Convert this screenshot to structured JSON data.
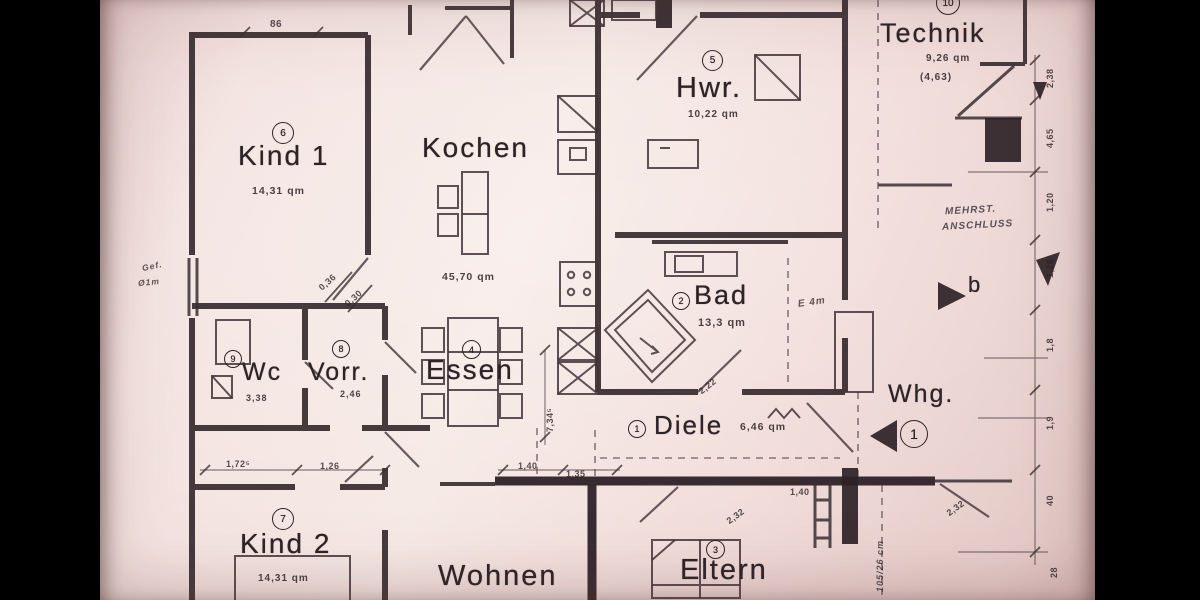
{
  "rooms": {
    "kind1": {
      "label": "Kind 1",
      "number": "6",
      "area": "14,31 qm"
    },
    "kochen": {
      "label": "Kochen",
      "area": "45,70 qm"
    },
    "hwr": {
      "label": "Hwr.",
      "number": "5",
      "area": "10,22 qm"
    },
    "technik": {
      "label": "Technik",
      "number": "10",
      "area": "9,26 qm",
      "area_alt": "(4,63)"
    },
    "bad": {
      "label": "Bad",
      "number": "2",
      "area": "13,3 qm"
    },
    "wc": {
      "label": "Wc",
      "number": "9",
      "area": "3,38"
    },
    "vorr": {
      "label": "Vorr.",
      "number": "8",
      "area": "2,46"
    },
    "essen": {
      "label": "Essen",
      "number": "4"
    },
    "diele": {
      "label": "Diele",
      "number": "1",
      "area": "6,46 qm"
    },
    "kind2": {
      "label": "Kind 2",
      "number": "7",
      "area": "14,31 qm"
    },
    "wohnen": {
      "label": "Wohnen"
    },
    "eltern": {
      "label": "Eltern",
      "number": "3"
    }
  },
  "unit": {
    "label": "Whg.",
    "number": "1"
  },
  "markers": {
    "b": "b"
  },
  "notes": {
    "line1": "MEHRST.",
    "line2": "ANSCHLUSS",
    "shaft": "105/26 cm",
    "e": "E 4m",
    "gef": "Gef.",
    "diam": "Ø1m"
  },
  "dims": {
    "top": "86",
    "diag1": "0,36",
    "diag2": "0,30",
    "kind2_a": "1,72⁵",
    "kind2_b": "1,26",
    "essen_v": "7,34⁵",
    "bad_door": "2,22",
    "entry_a": "1,40",
    "entry_b": "1,35",
    "entry_c": "2,32",
    "entry_d": "1,40",
    "eltern_door": "2,32",
    "right_chain": [
      "2,38",
      "4,65",
      "1,20",
      "1,26",
      "1,8",
      "1,9",
      "40",
      "28"
    ]
  }
}
